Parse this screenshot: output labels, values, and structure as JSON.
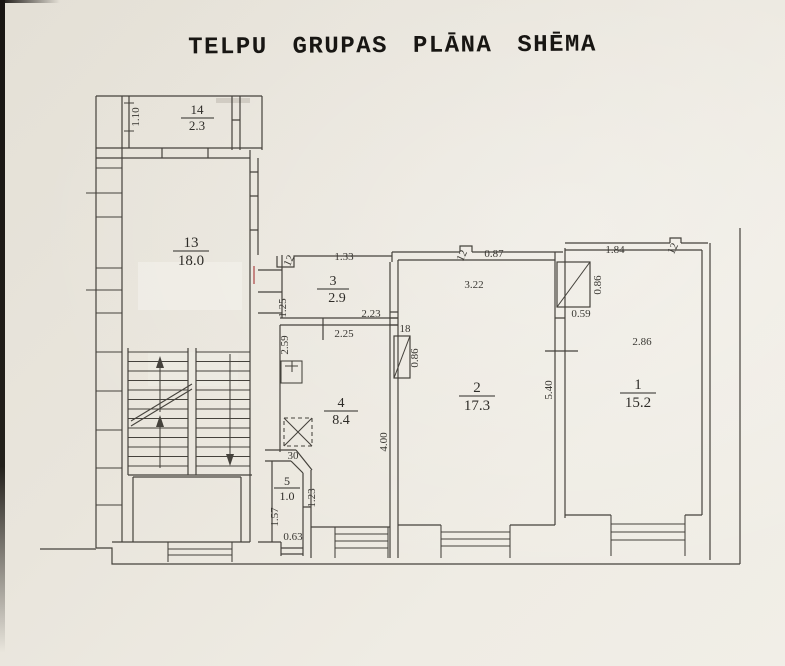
{
  "title": "TELPU GRUPAS PLĀNA SHĒMA",
  "colors": {
    "paper": "#eae6dd",
    "ink": "#45423c",
    "correction_mark": "#b05050"
  },
  "rooms": {
    "r14": {
      "num": "14",
      "area": "2.3"
    },
    "r13": {
      "num": "13",
      "area": "18.0"
    },
    "r3": {
      "num": "3",
      "area": "2.9"
    },
    "r4": {
      "num": "4",
      "area": "8.4"
    },
    "r5": {
      "num": "5",
      "area": "1.0"
    },
    "r2": {
      "num": "2",
      "area": "17.3"
    },
    "r1": {
      "num": "1",
      "area": "15.2"
    }
  },
  "dims": {
    "d110": "1.10",
    "d133": "1.33",
    "d12a": "12",
    "d125": "1.25",
    "d223": "2.23",
    "d225": "2.25",
    "d259": "2.59",
    "d087": "0.87",
    "d12b": "12",
    "d322": "3.22",
    "d18a": "18",
    "d086a": "0.86",
    "d400": "4.00",
    "d540": "5.40",
    "d059": "0.59",
    "d086b": "0.86",
    "d184": "1.84",
    "d12c": "12",
    "d286": "2.86",
    "d30": "30",
    "d157": "1.57",
    "d123": "1.23",
    "d063": "0.63"
  }
}
